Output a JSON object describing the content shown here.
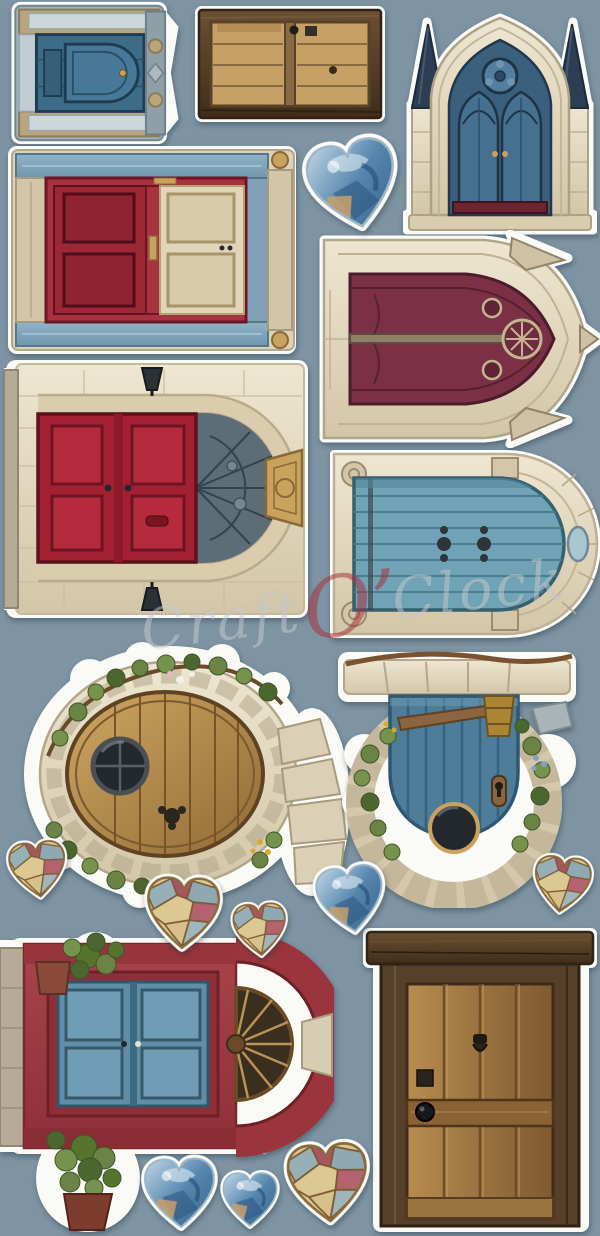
{
  "meta": {
    "description": "Die-cut scrapbooking sticker sheet with illustrated fantasy doors, gothic portals and decorative hearts on a slate-blue background",
    "background_color": "#7E94A3",
    "diecut_outline_color": "#FAFAF7"
  },
  "watermark": {
    "part1": "Craft",
    "part2": "O’",
    "part3": "Clock",
    "accent_color": "#A82C3A"
  },
  "palette": {
    "bg": "#7E94A3",
    "white": "#FAFAF7",
    "stone": "#E7DEC7",
    "stoneDark": "#CFC2A4",
    "stoneLine": "#B3A78B",
    "woodLight": "#C9A05C",
    "woodMid": "#8F6A34",
    "woodDark": "#57422A",
    "darkFrame": "#4F3A24",
    "blue": "#4E7D99",
    "blueDark": "#2E5872",
    "teal": "#6FA3B5",
    "navy": "#2D3D53",
    "red": "#A32032",
    "redFacade": "#9B3942",
    "maroon": "#7B3046",
    "cream": "#DDD2B8",
    "leaf": "#6B8446",
    "leafDark": "#47622F",
    "gold": "#C9A25E",
    "glass": "#7FA6C8",
    "ink": "#22364C"
  },
  "stickers": [
    {
      "name": "blue-ornate-door",
      "description": "Weathered blue paneled door in carved pale-blue and wood frame, rotated sideways",
      "colors": [
        "#3C6C88",
        "#9FB3BC",
        "#B9A67C"
      ]
    },
    {
      "name": "rustic-plank-door",
      "description": "Rustic wooden plank barn door with dark timber frame, rotated sideways",
      "colors": [
        "#C7A066",
        "#4F3A24"
      ]
    },
    {
      "name": "gothic-cathedral-door",
      "description": "Gothic cathedral portal with stone pointed arch, twin pinnacles and blue tracery double doors",
      "colors": [
        "#E7DEC7",
        "#3B607E",
        "#2D3D53"
      ]
    },
    {
      "name": "red-and-cream-double-door",
      "description": "Double door with red and cream leaves in a red frame with blue rails and stone pilasters, rotated sideways",
      "colors": [
        "#A83240",
        "#E0D5B8",
        "#7FA2B8"
      ]
    },
    {
      "name": "gothic-maroon-portal",
      "description": "Gothic stone portal with maroon tracery doors, rosette and pinnacles, rotated sideways",
      "colors": [
        "#7B3046",
        "#DED2B8"
      ]
    },
    {
      "name": "stone-arch-red-door",
      "description": "Round stone archway with red paneled double door, cobble fanlight, keystone and lanterns, rotated sideways",
      "colors": [
        "#A32032",
        "#E5DCC4",
        "#C9A25E"
      ]
    },
    {
      "name": "classical-arch-blue-door",
      "description": "Classical cream arch with weathered teal plank door, corner medallions and keystone, rotated sideways",
      "colors": [
        "#6FA3B5",
        "#E7DFC8"
      ]
    },
    {
      "name": "hobbit-round-door",
      "description": "Oval hobbit-style wooden door in a stone surround with ivy, porthole window and flagstone path, rotated sideways",
      "colors": [
        "#C9A05C",
        "#D8CDB2",
        "#6B8446"
      ]
    },
    {
      "name": "fairy-blue-door",
      "description": "Blue plank fairy door in a cobblestone arch with stone lintel, bucket, round window and greenery",
      "colors": [
        "#4E7D99",
        "#D4C7AA",
        "#AB8534"
      ]
    },
    {
      "name": "red-arch-blue-door",
      "description": "Red arched facade with blue paneled double doors, dark fan transom and potted shrubs, rotated sideways",
      "colors": [
        "#9B3942",
        "#5F8EA6",
        "#6B8446"
      ]
    },
    {
      "name": "rustic-wooden-door",
      "description": "Old rustic plank door with heavy timber lintel, knocker and black knob",
      "colors": [
        "#B08449",
        "#4F3A24"
      ]
    },
    {
      "name": "glass-heart-large",
      "description": "Glassy blue marble heart",
      "colors": [
        "#7FA6C8",
        "#2E5D86"
      ]
    },
    {
      "name": "mosaic-heart-small-left",
      "description": "Patchwork stained-glass heart in cream, blue and red",
      "colors": [
        "#DCC892",
        "#97B0B8",
        "#A85560"
      ]
    },
    {
      "name": "mosaic-heart-medium",
      "description": "Patchwork stained-glass heart in cream, blue and red",
      "colors": [
        "#DCC892",
        "#97B0B8",
        "#A85560"
      ]
    },
    {
      "name": "mosaic-heart-small-mid",
      "description": "Patchwork stained-glass heart in cream, blue and red",
      "colors": [
        "#DCC892",
        "#97B0B8",
        "#A85560"
      ]
    },
    {
      "name": "glass-heart-goldfish",
      "description": "Glassy blue heart with golden swirl",
      "colors": [
        "#7FA6C8",
        "#C9A06A"
      ]
    },
    {
      "name": "mosaic-heart-right",
      "description": "Patchwork stained-glass heart in cream, blue and red",
      "colors": [
        "#DCC892",
        "#97B0B8",
        "#A85560"
      ]
    },
    {
      "name": "glass-heart-bottom",
      "description": "Glassy blue watery heart",
      "colors": [
        "#7FA6C8",
        "#2E5D86"
      ]
    },
    {
      "name": "glass-heart-bottom-small",
      "description": "Small glassy blue heart",
      "colors": [
        "#7FA6C8",
        "#2E5D86"
      ]
    },
    {
      "name": "mosaic-heart-bottom",
      "description": "Patchwork stained-glass heart in cream, blue and red",
      "colors": [
        "#DCC892",
        "#97B0B8",
        "#A85560"
      ]
    }
  ]
}
